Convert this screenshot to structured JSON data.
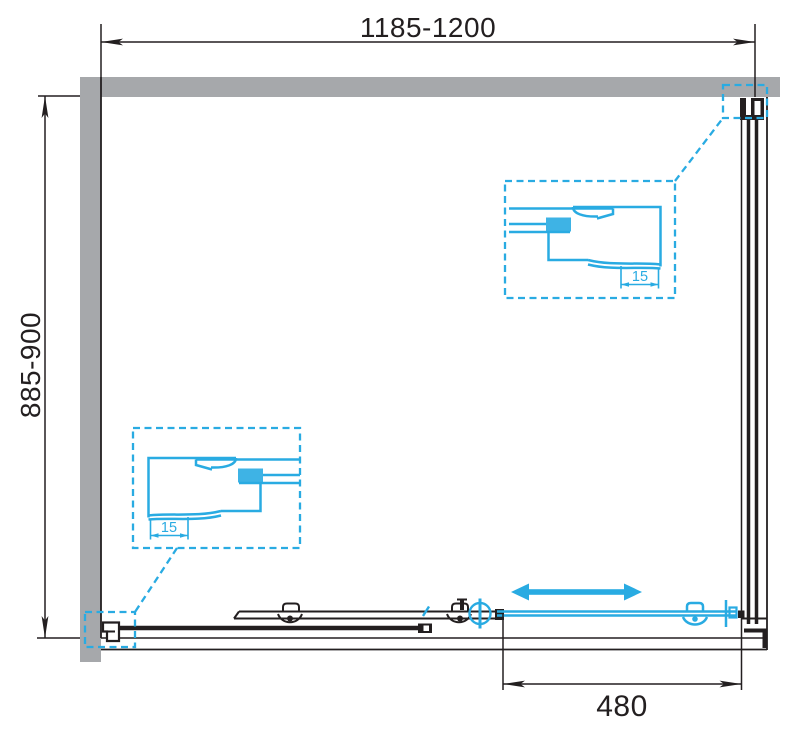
{
  "drawing": {
    "subject": "shower-enclosure-plan-view",
    "dimensions": {
      "width_range": "1185-1200",
      "depth_range": "885-900",
      "door_travel": "480"
    },
    "callouts": {
      "top_right_detail_label": "15",
      "bottom_left_detail_label": "15"
    },
    "colors": {
      "accent_blue": "#29abe2",
      "wall_gray": "#a6a8ab",
      "line_black": "#231f20",
      "background": "#ffffff"
    }
  }
}
